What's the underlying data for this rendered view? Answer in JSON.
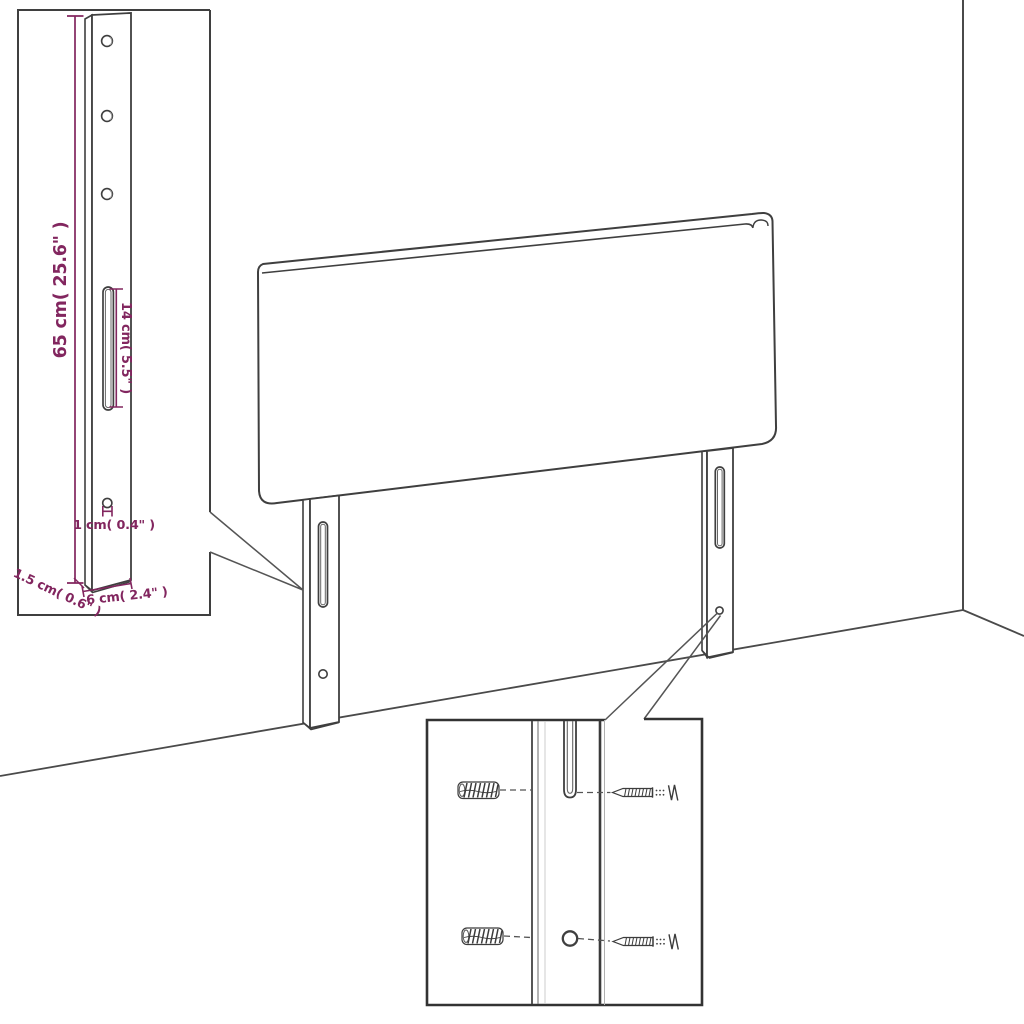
{
  "colors": {
    "background": "#ffffff",
    "line": "#3f3f3f",
    "dimension": "#82265f"
  },
  "bracket_inset": {
    "height_label": "65 cm( 25.6\" )",
    "slot_label": "14 cm( 5.5\" )",
    "hole_label": "1 cm( 0.4\" )",
    "depth_label": "1.5 cm( 0.6\" )",
    "width_label": "6 cm( 2.4\" )"
  }
}
